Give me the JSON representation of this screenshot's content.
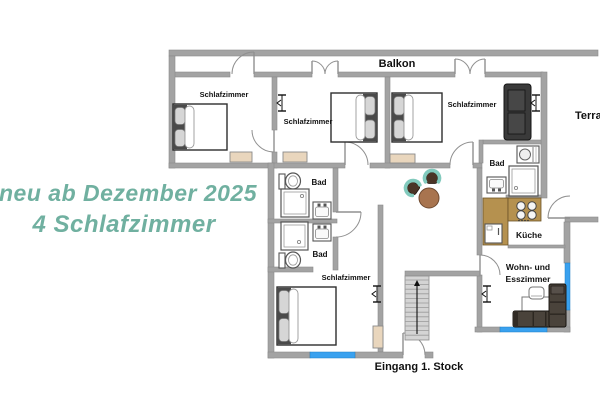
{
  "promo": {
    "line1": "neu ab Dezember 2025",
    "line2": "4 Schlafzimmer",
    "color": "#70b0a0"
  },
  "colors": {
    "wall": "#a3a3a3",
    "wall_stroke": "#8b8b8b",
    "door": "#909090",
    "window_blue": "#39a1ef",
    "radiator": "#e9d6bd",
    "counter": "#b5914f",
    "counter_stroke": "#6b5327",
    "stairs": "#d4d4d4",
    "table_brown": "#a8744f",
    "chair_teal": "#82cabd",
    "chair_seat": "#4a3426",
    "sofa_dark": "#3a3a3a",
    "sofa_brown": "#4a433b",
    "fixture_stroke": "#555555",
    "bed_frame": "#4a4a4a",
    "pillow": "#d6d6d6"
  },
  "plan": {
    "walls": [
      [
        169,
        50,
        429,
        6
      ],
      [
        170,
        72,
        60,
        5
      ],
      [
        254,
        72,
        58,
        5
      ],
      [
        338,
        72,
        117,
        5
      ],
      [
        485,
        72,
        58,
        5
      ],
      [
        169,
        56,
        6,
        112
      ],
      [
        272,
        77,
        5,
        53
      ],
      [
        272,
        152,
        5,
        16
      ],
      [
        385,
        77,
        5,
        91
      ],
      [
        541,
        72,
        6,
        126
      ],
      [
        169,
        163,
        176,
        5
      ],
      [
        370,
        163,
        80,
        5
      ],
      [
        473,
        163,
        9,
        5
      ],
      [
        483,
        140,
        58,
        4
      ],
      [
        479,
        140,
        4,
        23
      ],
      [
        506,
        195,
        35,
        3
      ],
      [
        477,
        168,
        5,
        87
      ],
      [
        477,
        275,
        5,
        57
      ],
      [
        565,
        217,
        33,
        5
      ],
      [
        564,
        222,
        6,
        41
      ],
      [
        564,
        310,
        6,
        22
      ],
      [
        475,
        327,
        25,
        5
      ],
      [
        547,
        327,
        23,
        5
      ],
      [
        508,
        245,
        57,
        3
      ],
      [
        268,
        163,
        6,
        195
      ],
      [
        333,
        168,
        5,
        44
      ],
      [
        333,
        237,
        5,
        33
      ],
      [
        268,
        219,
        69,
        4
      ],
      [
        268,
        267,
        45,
        5
      ],
      [
        378,
        205,
        5,
        147
      ],
      [
        405,
        271,
        75,
        5
      ],
      [
        268,
        352,
        42,
        6
      ],
      [
        355,
        352,
        48,
        6
      ],
      [
        425,
        352,
        8,
        6
      ]
    ],
    "windows": [
      [
        310,
        352,
        45,
        6
      ],
      [
        500,
        327,
        47,
        5
      ],
      [
        565,
        263,
        5,
        47
      ]
    ],
    "window_symbols": [
      [
        282,
        103
      ],
      [
        536,
        103
      ],
      [
        377,
        294
      ],
      [
        487,
        294
      ]
    ],
    "doors": [
      [
        254,
        74,
        22,
        -90,
        -180
      ],
      [
        312,
        74,
        13,
        -90,
        0
      ],
      [
        338,
        74,
        13,
        -90,
        -180
      ],
      [
        455,
        74,
        15,
        -90,
        0
      ],
      [
        485,
        74,
        15,
        -90,
        -180
      ],
      [
        274,
        130,
        22,
        90,
        180
      ],
      [
        345,
        165,
        23,
        -90,
        0
      ],
      [
        473,
        165,
        23,
        -90,
        -180
      ],
      [
        336,
        212,
        25,
        0,
        90
      ],
      [
        480,
        275,
        20,
        -90,
        0
      ],
      [
        570,
        218,
        22,
        180,
        270
      ],
      [
        403,
        355,
        22,
        -90,
        0
      ]
    ],
    "labels": [
      {
        "t": "Balkon",
        "x": 397,
        "y": 67,
        "s": 11
      },
      {
        "t": "Schlafzimmer",
        "x": 224,
        "y": 97,
        "s": 7.5
      },
      {
        "t": "Schlafzimmer",
        "x": 308,
        "y": 124,
        "s": 7.5
      },
      {
        "t": "Schlafzimmer",
        "x": 472,
        "y": 107,
        "s": 7.5
      },
      {
        "t": "Bad",
        "x": 319,
        "y": 185,
        "s": 8
      },
      {
        "t": "Bad",
        "x": 320,
        "y": 257,
        "s": 8
      },
      {
        "t": "Bad",
        "x": 497,
        "y": 166,
        "s": 8
      },
      {
        "t": "Küche",
        "x": 529,
        "y": 238,
        "s": 8.5
      },
      {
        "t": "Wohn- und",
        "x": 528,
        "y": 270,
        "s": 8.5
      },
      {
        "t": "Esszimmer",
        "x": 528,
        "y": 282,
        "s": 8.5
      },
      {
        "t": "Schlafzimmer",
        "x": 346,
        "y": 280,
        "s": 7.5
      },
      {
        "t": "Eingang 1. Stock",
        "x": 419,
        "y": 370,
        "s": 11
      },
      {
        "t": "Terrasse",
        "x": 575,
        "y": 119,
        "s": 11,
        "anchor": "start"
      }
    ],
    "furniture": [
      {
        "type": "bed",
        "name": "bed-top-left",
        "x": 173,
        "y": 104,
        "w": 54,
        "h": 46,
        "head": "left"
      },
      {
        "type": "bed",
        "name": "bed-middle",
        "x": 331,
        "y": 93,
        "w": 46,
        "h": 49,
        "head": "right"
      },
      {
        "type": "bed",
        "name": "bed-right",
        "x": 392,
        "y": 93,
        "w": 50,
        "h": 49,
        "head": "left"
      },
      {
        "type": "bed",
        "name": "bed-bottom",
        "x": 277,
        "y": 287,
        "w": 59,
        "h": 58,
        "head": "left"
      },
      {
        "type": "sofa2",
        "name": "loveseat",
        "x": 504,
        "y": 84,
        "w": 27,
        "h": 56
      },
      {
        "type": "radiator",
        "x": 230,
        "y": 152,
        "w": 22,
        "h": 10
      },
      {
        "type": "radiator",
        "x": 283,
        "y": 152,
        "w": 24,
        "h": 10
      },
      {
        "type": "radiator",
        "x": 390,
        "y": 154,
        "w": 25,
        "h": 9
      },
      {
        "type": "radiator",
        "x": 373,
        "y": 326,
        "w": 10,
        "h": 22
      },
      {
        "type": "toilet",
        "x": 279,
        "y": 172,
        "w": 22,
        "h": 18
      },
      {
        "type": "toilet",
        "x": 279,
        "y": 251,
        "w": 22,
        "h": 18
      },
      {
        "type": "shower",
        "x": 281,
        "y": 189,
        "w": 28,
        "h": 28,
        "dot": "tr"
      },
      {
        "type": "shower",
        "x": 281,
        "y": 222,
        "w": 27,
        "h": 28,
        "dot": "br"
      },
      {
        "type": "shower",
        "x": 509,
        "y": 166,
        "w": 29,
        "h": 30,
        "dot": "bl"
      },
      {
        "type": "sink",
        "x": 313,
        "y": 202,
        "w": 18,
        "h": 17,
        "tap": "top"
      },
      {
        "type": "sink",
        "x": 313,
        "y": 224,
        "w": 18,
        "h": 17,
        "tap": "top"
      },
      {
        "type": "sink",
        "x": 487,
        "y": 177,
        "w": 19,
        "h": 16,
        "tap": "bottom"
      },
      {
        "type": "washer",
        "x": 517,
        "y": 146,
        "w": 22,
        "h": 17
      },
      {
        "type": "counter",
        "x": 483,
        "y": 198,
        "w": 25,
        "h": 47
      },
      {
        "type": "counter",
        "x": 508,
        "y": 198,
        "w": 33,
        "h": 23
      },
      {
        "type": "stove",
        "x": 512,
        "y": 199,
        "w": 28,
        "h": 22
      },
      {
        "type": "fridge",
        "x": 485,
        "y": 224,
        "w": 17,
        "h": 19
      },
      {
        "type": "stairs",
        "x": 405,
        "y": 276,
        "w": 24,
        "h": 64
      },
      {
        "type": "roundtable",
        "x": 429,
        "y": 198,
        "r": 10
      },
      {
        "type": "chair",
        "x": 413,
        "y": 188,
        "rot": 35
      },
      {
        "type": "chair",
        "x": 432,
        "y": 178,
        "rot": 90
      },
      {
        "type": "desk",
        "x": 522,
        "y": 297,
        "w": 31,
        "h": 15
      },
      {
        "type": "deskchair",
        "x": 529,
        "y": 287,
        "w": 15,
        "h": 12
      },
      {
        "type": "sofaL",
        "x": 513,
        "y": 311,
        "w": 53,
        "h": 16,
        "orient": "h"
      },
      {
        "type": "sofaL",
        "x": 549,
        "y": 284,
        "w": 17,
        "h": 43,
        "orient": "v"
      }
    ]
  }
}
